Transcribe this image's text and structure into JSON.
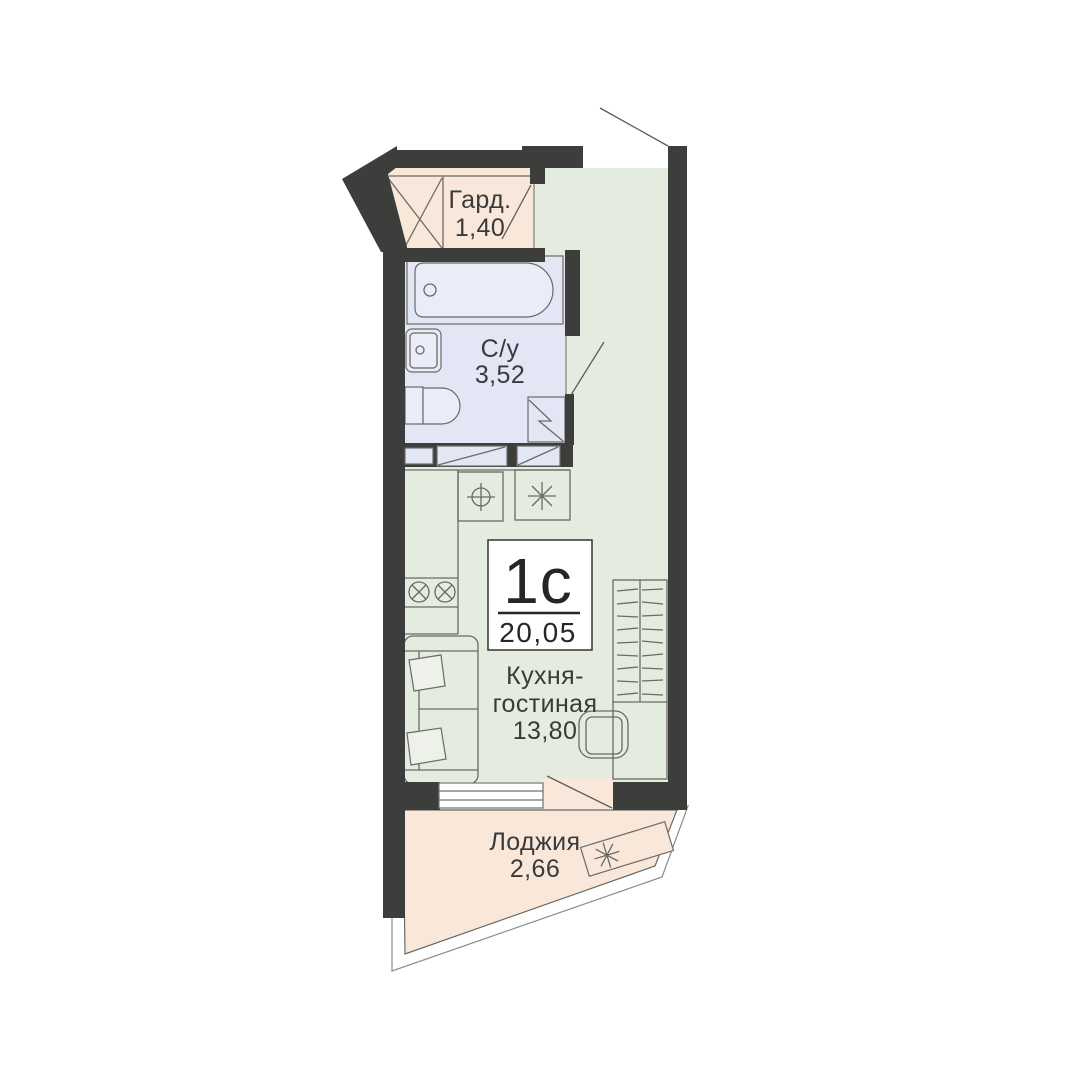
{
  "badge": {
    "type": "1с",
    "total_area": "20,05"
  },
  "rooms": {
    "wardrobe": {
      "label": "Гард.",
      "area": "1,40"
    },
    "bathroom": {
      "label": "С/у",
      "area": "3,52"
    },
    "kitchen_living": {
      "label_line1": "Кухня-",
      "label_line2": "гостиная",
      "area": "13,80"
    },
    "loggia": {
      "label": "Лоджия",
      "area": "2,66"
    }
  },
  "colors": {
    "wall": "#3d3d3b",
    "floorMain": "#e4ebdf",
    "floorBath": "#e3e7f5",
    "floorWarm": "#f9e8da",
    "fixture": "#eaedf8",
    "pillow": "#eef1ea",
    "line": "#6a6a66",
    "swing": "#5c5c60",
    "outline": "#8c8c8a",
    "windowFrame": "#72726e",
    "text": "#3a3a3a",
    "badgeText": "#262626"
  }
}
